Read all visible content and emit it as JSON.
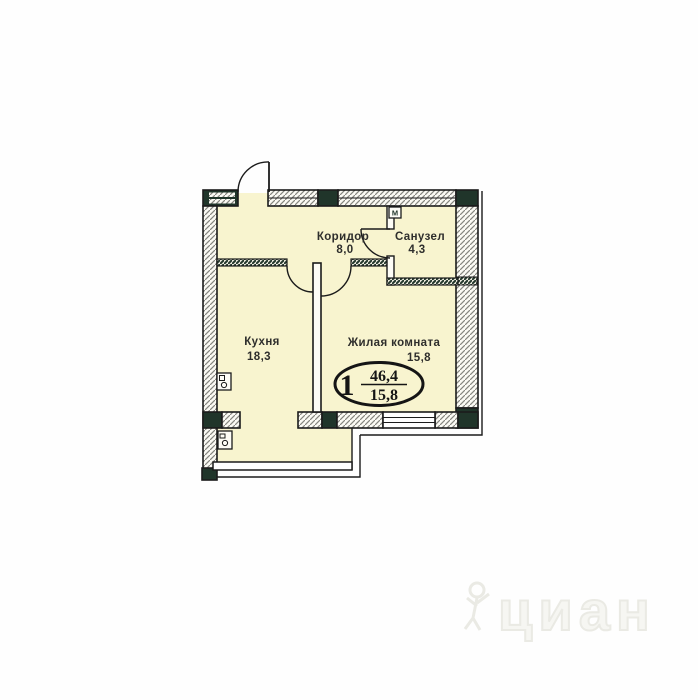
{
  "plan": {
    "rooms": [
      {
        "name": "Коридор",
        "area": "8,0"
      },
      {
        "name": "Санузел",
        "area": "4,3"
      },
      {
        "name": "Кухня",
        "area": "18,3"
      },
      {
        "name": "Жилая комната",
        "area": "15,8"
      }
    ],
    "badge": {
      "rooms": "1",
      "total_area": "46,4",
      "living_area": "15,8"
    },
    "vent_label": "М"
  },
  "watermark": {
    "text": "циан"
  },
  "colors": {
    "room_fill": "#f8f4cf",
    "wall_dark": "#20352a",
    "line": "#1b1b1b",
    "hatch_line": "#85857f"
  }
}
